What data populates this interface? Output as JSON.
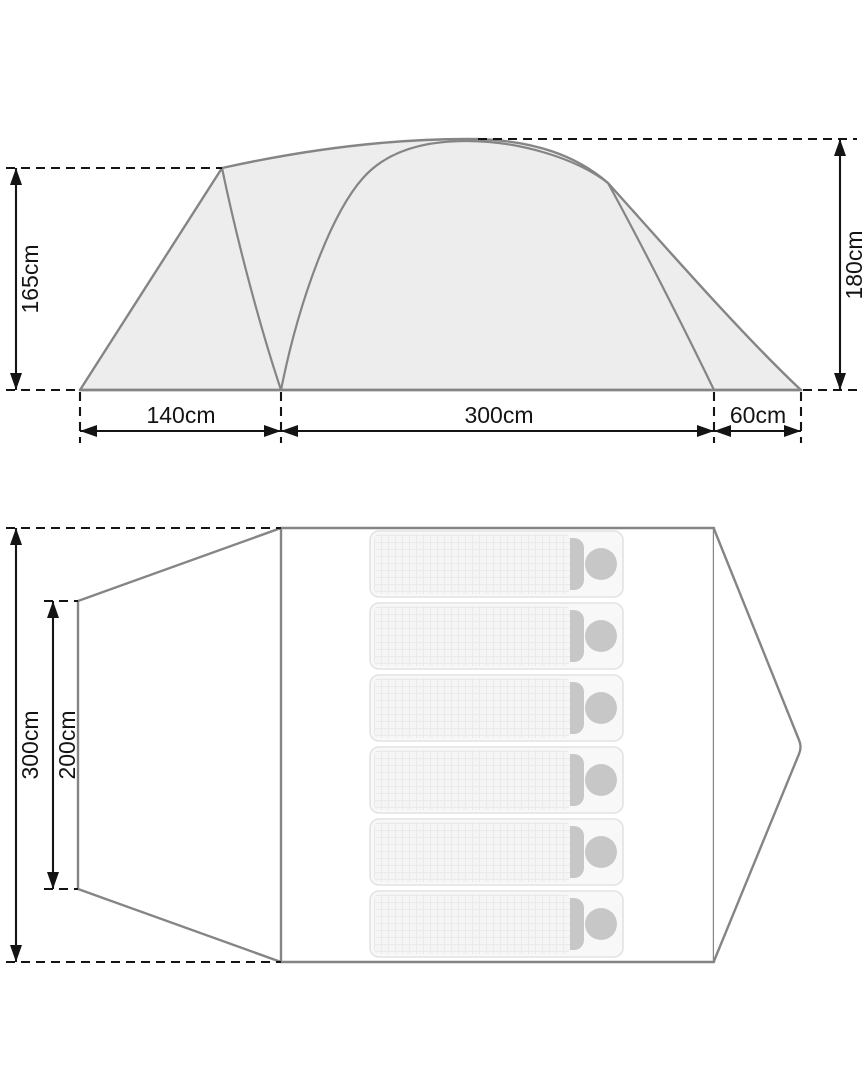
{
  "page": {
    "background": "#ffffff",
    "description": "Tent dimension diagram with side elevation and floor plan"
  },
  "side_view": {
    "name": "tent-side-elevation",
    "labels": {
      "height_left": "165cm",
      "height_right": "180cm",
      "width_porch": "140cm",
      "width_main": "300cm",
      "width_rear": "60cm"
    }
  },
  "floor_plan": {
    "name": "tent-floor-plan",
    "labels": {
      "length_total": "300cm",
      "length_inner": "200cm"
    },
    "sleeping_pads": 6
  },
  "colors": {
    "outline": "#858585",
    "tent_fill": "#ededed",
    "dim": "#141414",
    "plan_fill": "#ffffff",
    "pad_fill": "#f8f8f8",
    "pad_border": "#e3e3e3",
    "mattress_fill": "#f5f5f5",
    "mattress_line": "#eaeaea",
    "pad_head": "#c7c7c7"
  }
}
